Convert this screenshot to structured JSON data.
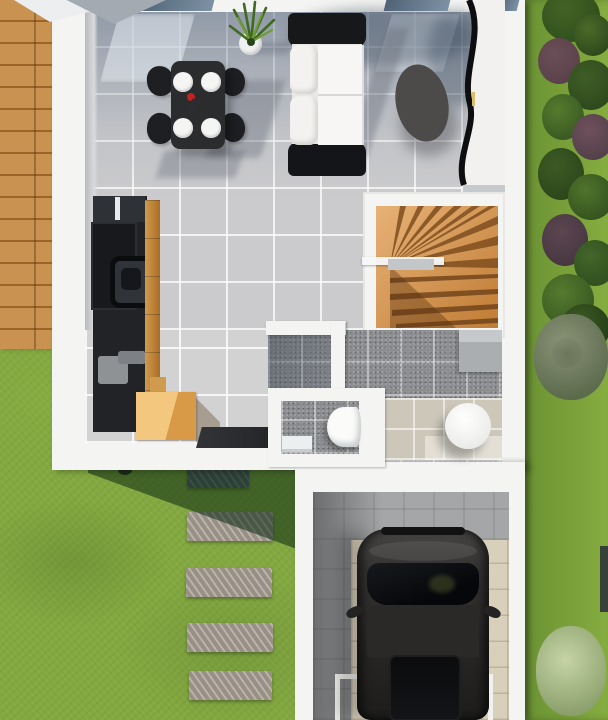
{
  "scene": {
    "type": "3d-floor-plan-render",
    "view": "top-down",
    "description": "3D rendered ground-floor plan: living/dining room with sofa and dining set, kitchen block, winder staircase, bathroom with WC, attached garage with parked car, wooden deck, stepping-stone path and garden"
  },
  "rooms": [
    {
      "name": "living-dining-room"
    },
    {
      "name": "kitchen"
    },
    {
      "name": "staircase"
    },
    {
      "name": "bathroom"
    },
    {
      "name": "wc"
    },
    {
      "name": "garage"
    },
    {
      "name": "wooden-deck"
    },
    {
      "name": "garden"
    }
  ],
  "objects": [
    {
      "name": "dining-table",
      "color": "#2a2c2e",
      "plates": 4
    },
    {
      "name": "dining-chairs",
      "count": 4,
      "color": "#1d1f22"
    },
    {
      "name": "potted-plant",
      "pot_color": "#eff0f0"
    },
    {
      "name": "sofa",
      "cushions": "#f3f2f0",
      "frame": "#17181a"
    },
    {
      "name": "coffee-table",
      "shape": "oval",
      "color": "#4c4b49"
    },
    {
      "name": "media-unit",
      "shape": "s-curved",
      "color": "#f2f1ef"
    },
    {
      "name": "kitchen-unit",
      "color": "#212327",
      "accent": "#c9802f"
    },
    {
      "name": "wooden-crate",
      "color": "#ecb968"
    },
    {
      "name": "doormat",
      "color": "#26272a"
    },
    {
      "name": "winder-staircase",
      "wood": "#d1924e"
    },
    {
      "name": "toilet",
      "color": "#fbfbfa"
    },
    {
      "name": "shower-base",
      "shape": "round",
      "color": "#fbfbfa"
    },
    {
      "name": "storage-cabinet",
      "color": "#abaeb0"
    },
    {
      "name": "car",
      "color": "#2f2d2c"
    },
    {
      "name": "stepping-stones",
      "count": 5,
      "color": "#a39a8f"
    },
    {
      "name": "garden-bushes"
    },
    {
      "name": "tree"
    },
    {
      "name": "garage-mat",
      "color": "#d9d0bb"
    }
  ],
  "palette": {
    "grass_base": "#85ab3d",
    "grass_right": "#6a9233",
    "grass_shadow": "rgba(12,42,18,0.55)",
    "deck_wood": "#c99250",
    "house_white": "#f4f4f2",
    "tile_light": "#cbcbcd",
    "dark_tile": "#8b8d90",
    "beige_tile": "#cdc7ba",
    "glass": "#4f6275",
    "stairs_wood": "#d1924e",
    "stairs_tread": "#7f4e1f",
    "kitchen_black": "#212327",
    "wood_accent": "#c9802f",
    "crate_wood": "#ecb968",
    "sofa_white": "#f3f2f0",
    "sofa_black": "#17181a",
    "table_black": "#2a2c2e",
    "chair_black": "#1d1f22",
    "plate_white": "#f5f5f4",
    "coffee_table": "#4c4b49",
    "cabinet_gray": "#abaeb0",
    "stone_gray": "#a39a8f",
    "stone_shadow": "#5e6670",
    "garage_floor": "#a4a6a7",
    "garage_mat": "#d9d0bb",
    "car_body": "#2f2d2c",
    "car_glass": "#0e0f11",
    "bush_dark": "#30501e",
    "bush_purple": "#5a4149",
    "tree_sage": "#8a9377",
    "bush_light": "#c6d4a6",
    "accent_red": "#c32222"
  }
}
